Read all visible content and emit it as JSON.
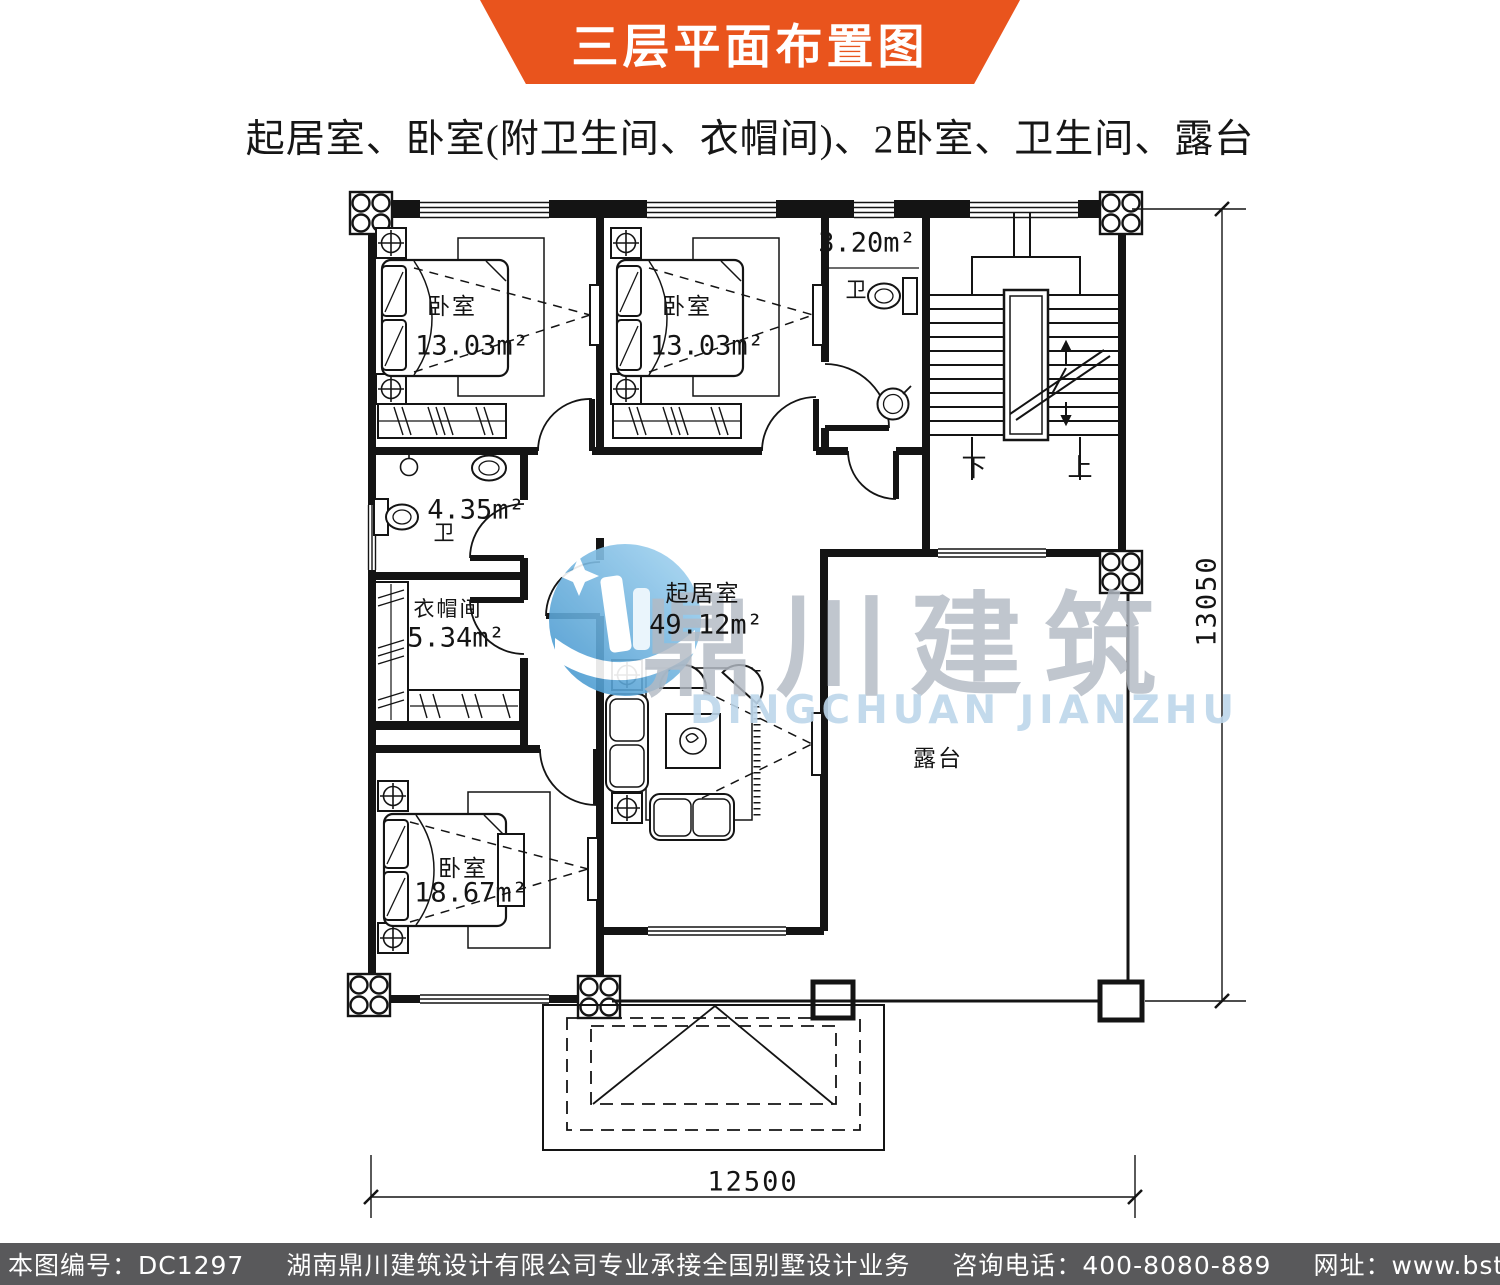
{
  "banner": {
    "title": "三层平面布置图",
    "color": "#e9541d"
  },
  "subtitle": "起居室、卧室(附卫生间、衣帽间)、2卧室、卫生间、露台",
  "plan": {
    "rooms": {
      "bedroom_top_left": {
        "name": "卧室",
        "area": "13.03m²"
      },
      "bedroom_top_middle": {
        "name": "卧室",
        "area": "13.03m²"
      },
      "bathroom_top": {
        "name": "卫",
        "area": "3.20m²"
      },
      "bathroom_left": {
        "name": "卫",
        "area": "4.35m²"
      },
      "cloakroom": {
        "name": "衣帽间",
        "area": "5.34m²"
      },
      "bedroom_bottom": {
        "name": "卧室",
        "area": "18.67m²"
      },
      "living_room": {
        "name": "起居室",
        "area": "49.12m²"
      },
      "terrace": {
        "name": "露台"
      }
    },
    "stairs": {
      "down": "下",
      "up": "上"
    },
    "dimensions": {
      "width": "12500",
      "height": "13050"
    }
  },
  "watermark": {
    "cn": "鼎川建筑",
    "en": "DINGCHUAN JIANZHU"
  },
  "footer": {
    "bg": "#59595b",
    "items": [
      "本图编号：DC1297",
      "湖南鼎川建筑设计有限公司专业承接全国别墅设计业务",
      "咨询电话：400-8080-889",
      "网址：www.bstzcs.com"
    ]
  }
}
